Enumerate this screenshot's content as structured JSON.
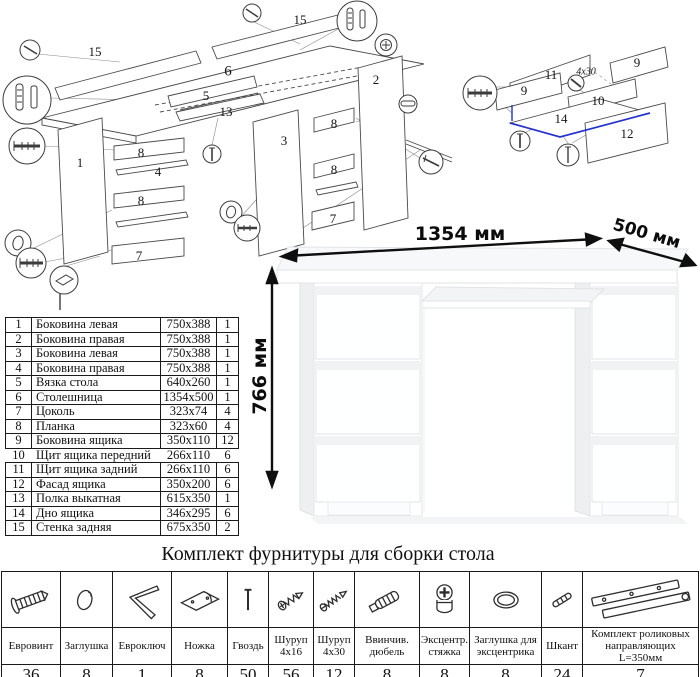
{
  "main_diagram": {
    "labels": [
      {
        "text": "15",
        "x": 95,
        "y": 52
      },
      {
        "text": "6",
        "x": 228,
        "y": 72,
        "cls": "big"
      },
      {
        "text": "15",
        "x": 300,
        "y": 20
      },
      {
        "text": "5",
        "x": 206,
        "y": 96
      },
      {
        "text": "13",
        "x": 226,
        "y": 112
      },
      {
        "text": "3",
        "x": 284,
        "y": 141
      },
      {
        "text": "2",
        "x": 376,
        "y": 80
      },
      {
        "text": "1",
        "x": 80,
        "y": 163
      },
      {
        "text": "8",
        "x": 141,
        "y": 153
      },
      {
        "text": "4",
        "x": 158,
        "y": 172
      },
      {
        "text": "8",
        "x": 141,
        "y": 201
      },
      {
        "text": "7",
        "x": 139,
        "y": 256
      },
      {
        "text": "8",
        "x": 334,
        "y": 124
      },
      {
        "text": "8",
        "x": 334,
        "y": 170
      },
      {
        "text": "7",
        "x": 333,
        "y": 219
      }
    ]
  },
  "drawer_diagram": {
    "labels": [
      {
        "text": "11",
        "x": 101,
        "y": 40
      },
      {
        "text": "9",
        "x": 187,
        "y": 28
      },
      {
        "text": "9",
        "x": 74,
        "y": 56
      },
      {
        "text": "10",
        "x": 148,
        "y": 66
      },
      {
        "text": "14",
        "x": 111,
        "y": 84
      },
      {
        "text": "12",
        "x": 177,
        "y": 99
      },
      {
        "text": "4x30",
        "x": 136,
        "y": 37,
        "cls": "small"
      }
    ]
  },
  "parts_table": {
    "rows": [
      [
        "1",
        "Боковина левая",
        "750x388",
        "1"
      ],
      [
        "2",
        "Боковина правая",
        "750x388",
        "1"
      ],
      [
        "3",
        "Боковина левая",
        "750x388",
        "1"
      ],
      [
        "4",
        "Боковина правая",
        "750x388",
        "1"
      ],
      [
        "5",
        "Вязка стола",
        "640x260",
        "1"
      ],
      [
        "6",
        "Столешница",
        "1354x500",
        "1"
      ],
      [
        "7",
        "Цоколь",
        "323x74",
        "4"
      ],
      [
        "8",
        "Планка",
        "323x60",
        "4"
      ],
      [
        "9",
        "Боковина ящика",
        "350x110",
        "12"
      ],
      [
        "10",
        "Щит ящика передний",
        "266x110",
        "6"
      ],
      [
        "11",
        "Щит ящика задний",
        "266x110",
        "6"
      ],
      [
        "12",
        "Фасад ящика",
        "350x200",
        "6"
      ],
      [
        "13",
        "Полка выкатная",
        "615x350",
        "1"
      ],
      [
        "14",
        "Дно ящика",
        "346x295",
        "6"
      ],
      [
        "15",
        "Стенка задняя",
        "675x350",
        "2"
      ]
    ]
  },
  "desk": {
    "width_label": "1354 мм",
    "depth_label": "500 мм",
    "height_label": "766 мм"
  },
  "hardware": {
    "title": "Комплект фурнитуры для сборки стола",
    "items": [
      {
        "name": "Евровинт",
        "qty": "36",
        "icon": "euroscrew-icon"
      },
      {
        "name": "Заглушка",
        "qty": "8",
        "icon": "plug-icon"
      },
      {
        "name": "Евроключ",
        "qty": "1",
        "icon": "hexkey-icon"
      },
      {
        "name": "Ножка",
        "qty": "8",
        "icon": "foot-icon"
      },
      {
        "name": "Гвоздь",
        "qty": "50",
        "icon": "nail-icon"
      },
      {
        "name": "Шуруп 4x16",
        "qty": "56",
        "icon": "screw-short-icon"
      },
      {
        "name": "Шуруп 4x30",
        "qty": "12",
        "icon": "screw-long-icon"
      },
      {
        "name": "Ввинчив. дюбель",
        "qty": "8",
        "icon": "dowel-screw-icon"
      },
      {
        "name": "Эксцентр. стяжка",
        "qty": "8",
        "icon": "cam-lock-icon"
      },
      {
        "name": "Заглушка для эксцентрика",
        "qty": "8",
        "icon": "cam-cap-icon"
      },
      {
        "name": "Шкант",
        "qty": "24",
        "icon": "wood-dowel-icon"
      },
      {
        "name": "Комплект роликовых направляющих L=350мм",
        "qty": "7",
        "icon": "drawer-slide-icon"
      }
    ]
  }
}
